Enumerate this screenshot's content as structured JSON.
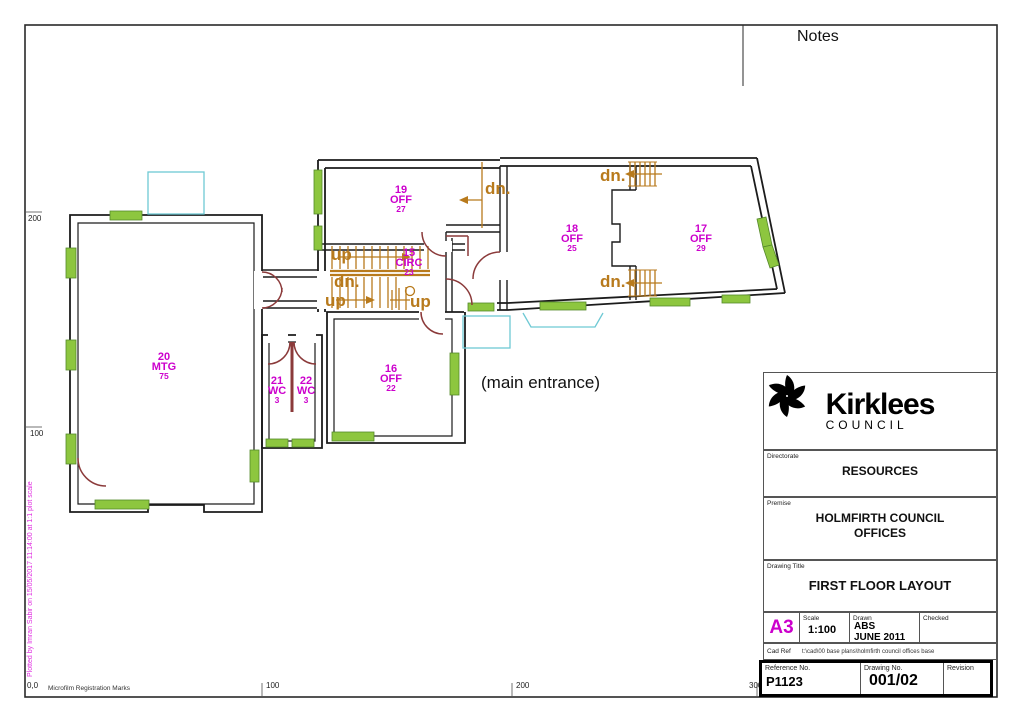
{
  "sheet": {
    "notes_label": "Notes",
    "main_entrance": "(main entrance)",
    "plot_note": "Plotted by Imran Sabir on 15/05/2017 11:14:00 at 1:1 plot scale",
    "microfilm": "Microfilm Registration Marks",
    "origin_label": "0,0",
    "bottom_ticks": [
      "100",
      "200",
      "300"
    ],
    "left_ticks": [
      "200",
      "100"
    ]
  },
  "rooms": {
    "r20": {
      "num": "20",
      "use": "MTG",
      "area": "75"
    },
    "r21": {
      "num": "21",
      "use": "WC",
      "area": "3"
    },
    "r22": {
      "num": "22",
      "use": "WC",
      "area": "3"
    },
    "r16": {
      "num": "16",
      "use": "OFF",
      "area": "22"
    },
    "r15": {
      "num": "15",
      "use": "CIRC",
      "area": "23"
    },
    "r19": {
      "num": "19",
      "use": "OFF",
      "area": "27"
    },
    "r18": {
      "num": "18",
      "use": "OFF",
      "area": "25"
    },
    "r17": {
      "num": "17",
      "use": "OFF",
      "area": "29"
    }
  },
  "stairs": {
    "up_main": "up",
    "dn_main": "dn.",
    "up_lower": "up",
    "up_spiral": "up",
    "dn_r19": "dn.",
    "dn_wing_top": "dn.",
    "dn_wing_bottom": "dn."
  },
  "title_block": {
    "logo_name": "Kirklees",
    "logo_sub": "COUNCIL",
    "directorate_label": "Directorate",
    "directorate": "RESOURCES",
    "premise_label": "Premise",
    "premise": "HOLMFIRTH COUNCIL OFFICES",
    "drawing_title_label": "Drawing Title",
    "drawing_title": "FIRST FLOOR LAYOUT",
    "paper_size": "A3",
    "scale_label": "Scale",
    "scale": "1:100",
    "drawn_label": "Drawn",
    "drawn_by": "ABS",
    "drawn_date": "JUNE 2011",
    "checked_label": "Checked",
    "checked": "",
    "cad_ref_label": "Cad Ref",
    "cad_ref": "t:\\cad\\00 base plans\\holmfirth council offices base",
    "reference_no_label": "Reference No.",
    "reference_no": "P1123",
    "drawing_no_label": "Drawing No.",
    "drawing_no": "001/02",
    "revision_label": "Revision",
    "revision": ""
  },
  "colors": {
    "room_label": "#cc00cc",
    "stair_annotation": "#b87a1c",
    "window": "#8dc63f",
    "door": "#8b3a3a",
    "canopy": "#6ec9d4",
    "plot_note": "#e02ce0"
  }
}
